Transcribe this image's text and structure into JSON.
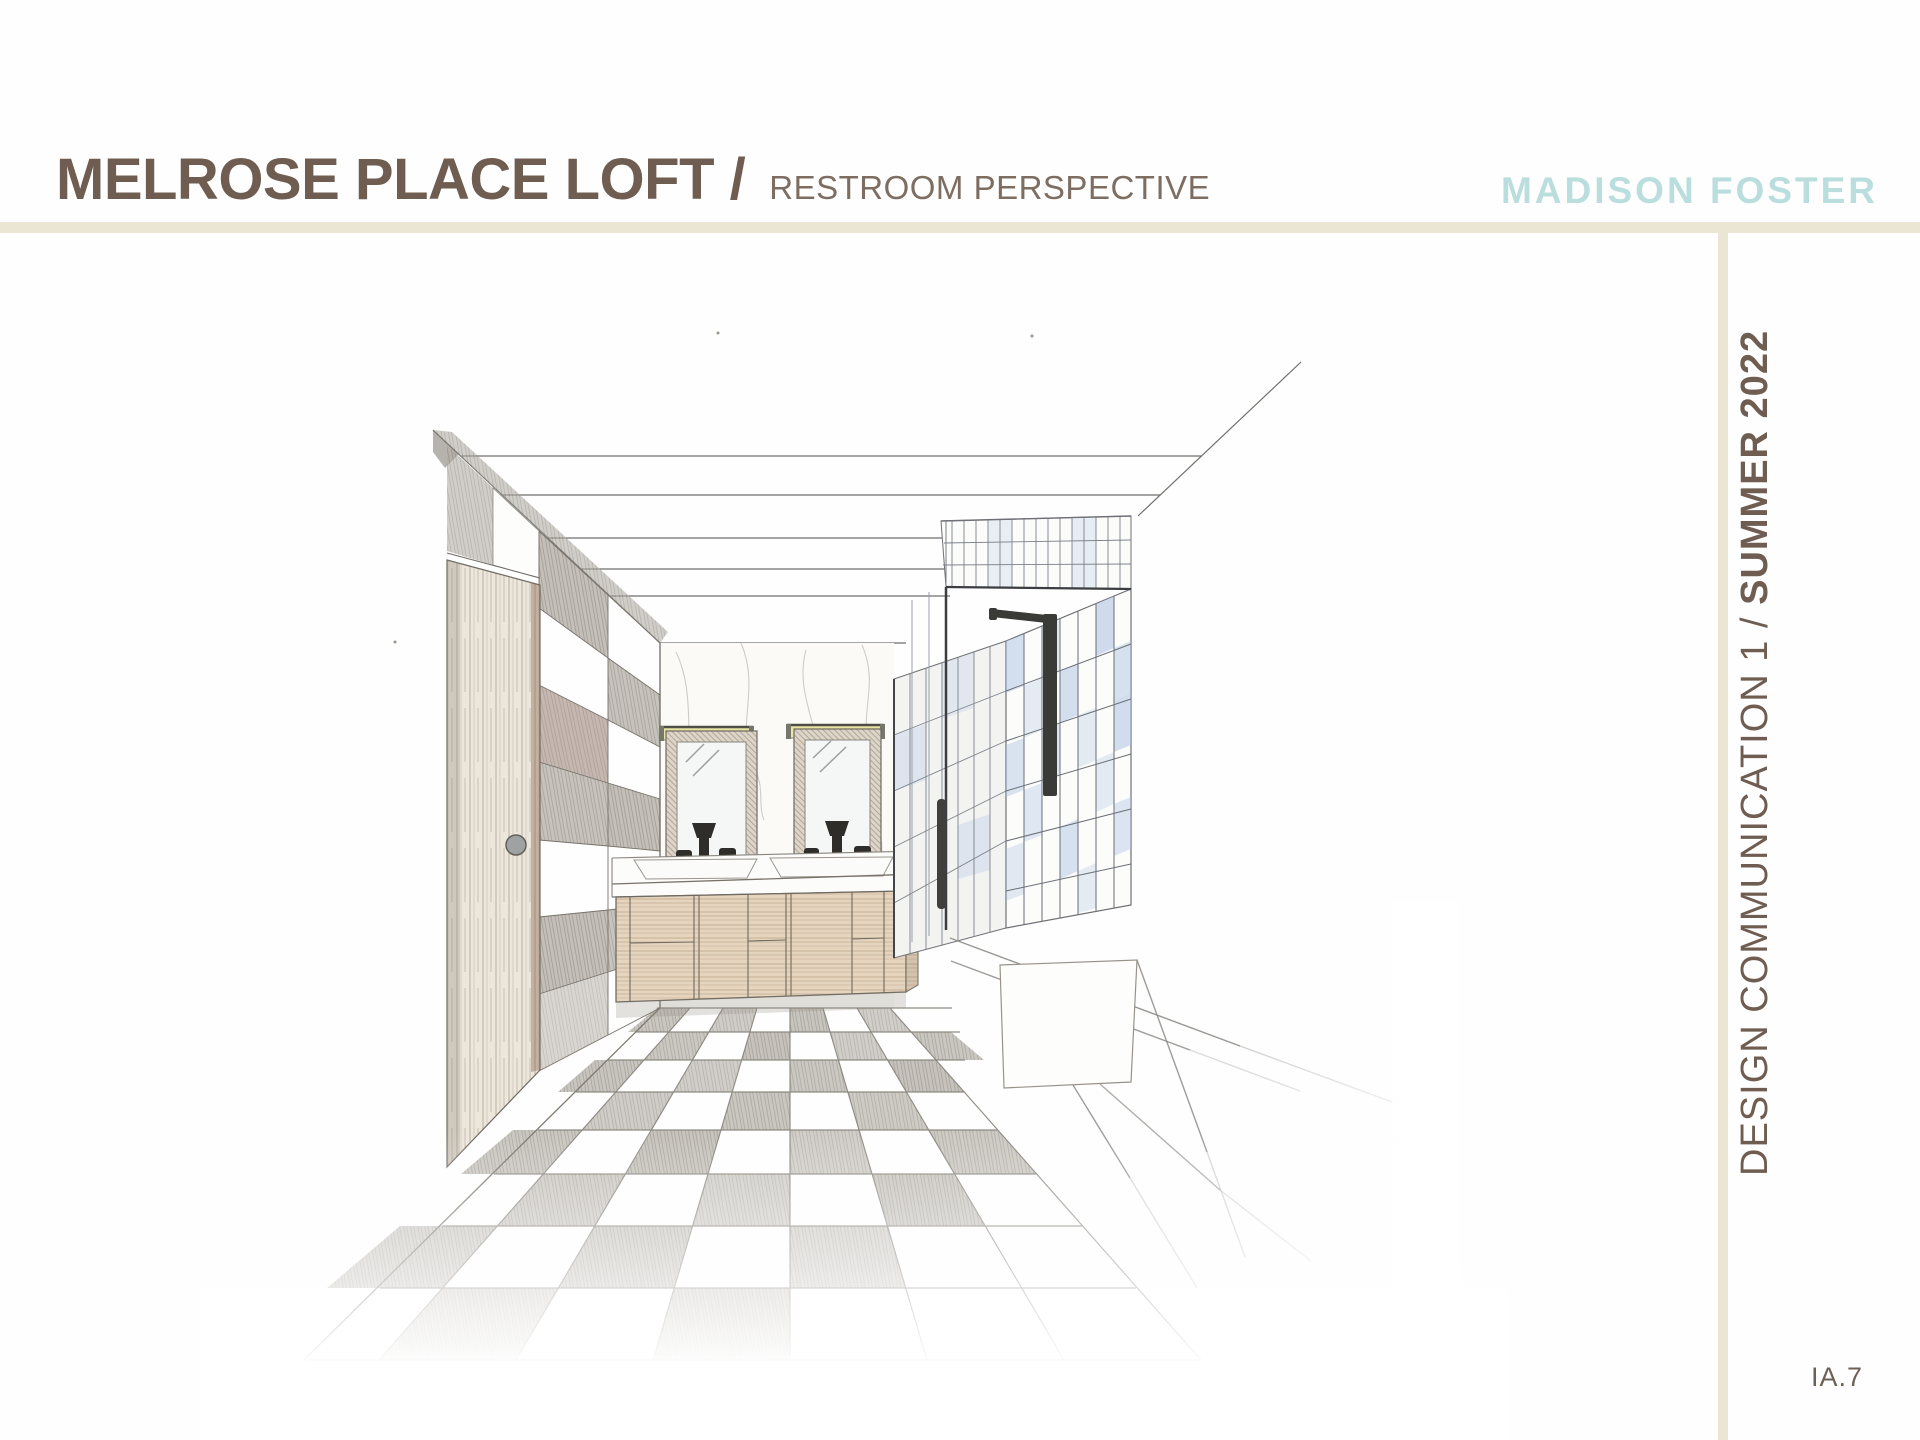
{
  "header": {
    "title": "MELROSE PLACE LOFT /",
    "subtitle": "RESTROOM PERSPECTIVE",
    "logo": "MADISON FOSTER"
  },
  "sidebar": {
    "course": "DESIGN COMMUNICATION 1 / ",
    "term": "SUMMER 2022"
  },
  "footer": {
    "page_number": "IA.7"
  },
  "drawing": {
    "description": "Hand-drawn one-point perspective pencil sketch of a restroom: checkerboard tile floor, wood door, checker accent wall, marble back wall with double vanity, two mirrors with light bars, glass shower with blue tile, sunken bathtub"
  },
  "colors": {
    "heading_brown": "#6e5d50",
    "logo_teal": "#b9dedd",
    "divider_beige": "#ebe5d3",
    "page_number_gray": "#6b6156",
    "blue_tile": "#a9c0e2",
    "wood_tan": "#ab8a68"
  }
}
